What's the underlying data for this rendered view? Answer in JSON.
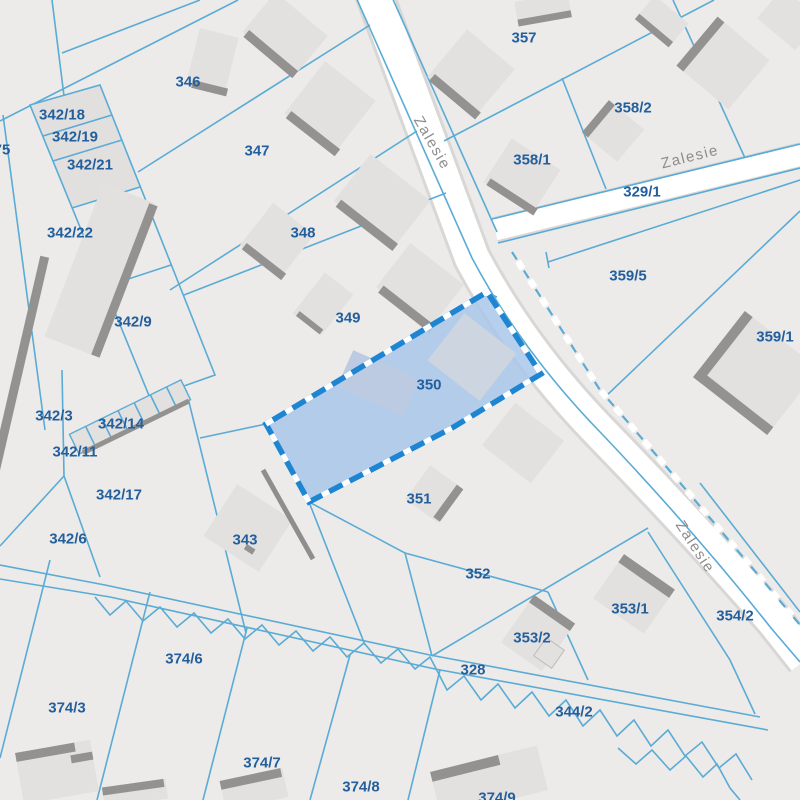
{
  "labels": {
    "p75": "75",
    "p342_18": "342/18",
    "p342_19": "342/19",
    "p342_21": "342/21",
    "p342_22": "342/22",
    "p342_9": "342/9",
    "p342_3": "342/3",
    "p342_14": "342/14",
    "p342_11": "342/11",
    "p342_17": "342/17",
    "p342_6": "342/6",
    "p346": "346",
    "p347": "347",
    "p348": "348",
    "p349": "349",
    "p350": "350",
    "p351": "351",
    "p352": "352",
    "p343": "343",
    "p357": "357",
    "p358_1": "358/1",
    "p358_2": "358/2",
    "p329_1": "329/1",
    "p359_5": "359/5",
    "p359_1": "359/1",
    "p353_1": "353/1",
    "p353_2": "353/2",
    "p328": "328",
    "p344_2": "344/2",
    "p354_2": "354/2",
    "p374_6": "374/6",
    "p374_3": "374/3",
    "p374_7": "374/7",
    "p374_8": "374/8",
    "p374_9": "374/9"
  },
  "streets": {
    "zalesie_north": "Zalesie",
    "zalesie_east": "Zalesie",
    "zalesie_south": "Zalesie"
  },
  "selected_parcel": {
    "id": "350"
  },
  "colors": {
    "background": "#ecebe9",
    "boundary": "#5aabd5",
    "road": "#ffffff",
    "road_casing": "#d8d7d6",
    "building": "#e3e1e0",
    "building_shadow": "#939291",
    "parcel_label": "#235f9c",
    "street_label": "#8d8c8b",
    "selection_fill": "#a9c7e9",
    "selection_border": "#1d85d2"
  }
}
